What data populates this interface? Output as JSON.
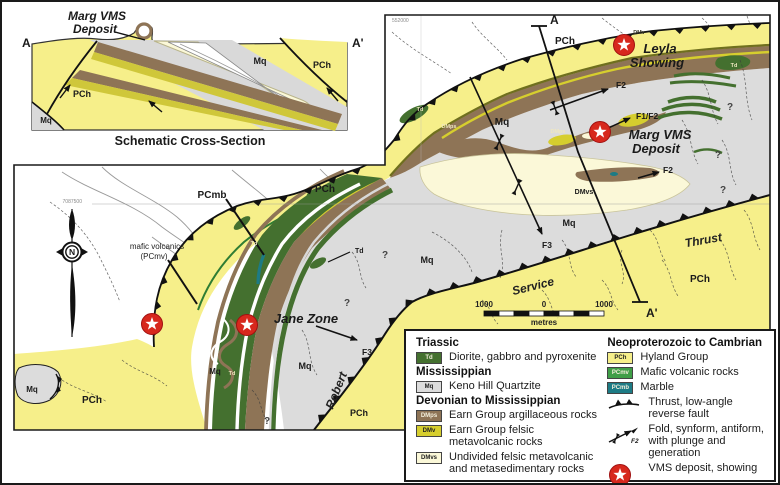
{
  "cross_section": {
    "marker_left": "A",
    "marker_right": "A'",
    "deposit_line1": "Marg VMS",
    "deposit_line2": "Deposit",
    "caption": "Schematic Cross-Section"
  },
  "map": {
    "marker_top": "A",
    "marker_bottom": "A'",
    "grid_easting": "552000",
    "grid_northing": "7087500",
    "north": "N",
    "locations": {
      "leyla_line1": "Leyla",
      "leyla_line2": "Showing",
      "marg_line1": "Marg VMS",
      "marg_line2": "Deposit",
      "jane": "Jane Zone"
    },
    "fault_name": {
      "robert": "Robert",
      "service": "Service",
      "thrust": "Thrust"
    },
    "folds": {
      "f2": "F2",
      "f1f2": "F1/F2",
      "f3": "F3"
    },
    "uncertain": "?",
    "codes": {
      "pch": "PCh",
      "mq": "Mq",
      "td": "Td",
      "dmps": "DMps",
      "dmv": "DMv",
      "dmvs": "DMvs",
      "pcmb": "PCmb"
    },
    "annotation": {
      "mafic_line1": "mafic volcanics",
      "mafic_line2": "(PCmv)"
    },
    "scale": {
      "left": "1000",
      "zero": "0",
      "right": "1000",
      "unit": "metres"
    }
  },
  "legend": {
    "groups": [
      {
        "heading": "Triassic",
        "items": [
          {
            "code": "Td",
            "label": "Diorite, gabbro and pyroxenite",
            "color": "#44702f"
          }
        ]
      },
      {
        "heading": "Mississippian",
        "items": [
          {
            "code": "Mq",
            "label": "Keno Hill Quartzite",
            "color": "#dcdcdc"
          }
        ]
      },
      {
        "heading": "Devonian to Mississippian",
        "items": [
          {
            "code": "DMps",
            "label": "Earn Group argillaceous rocks",
            "color": "#8e7456"
          },
          {
            "code": "DMv",
            "label": "Earn Group felsic metavolcanic rocks",
            "color": "#d6ce2e"
          },
          {
            "code": "DMvs",
            "label": "Undivided felsic metavolcanic and metasedimentary rocks",
            "color": "#fbf8d8"
          }
        ]
      },
      {
        "heading": "Neoproterozoic to Cambrian",
        "items": [
          {
            "code": "PCh",
            "label": "Hyland Group",
            "color": "#f6ef8a"
          },
          {
            "code": "PCmv",
            "label": "Mafic volcanic rocks",
            "color": "#3f9e47"
          },
          {
            "code": "PCmb",
            "label": "Marble",
            "color": "#1d7b85"
          }
        ]
      }
    ],
    "symbols": [
      {
        "label": "Thrust, low-angle reverse fault"
      },
      {
        "label": "Fold, synform, antiform, with plunge and generation",
        "tag": "F2"
      },
      {
        "label": "VMS deposit, showing"
      }
    ]
  },
  "colors": {
    "pch": "#f6ef8a",
    "mq": "#dcdcdc",
    "dmps": "#8e7456",
    "dmv": "#d6ce2e",
    "dmvs": "#fbf8d8",
    "td": "#44702f",
    "pcmv": "#3f9e47",
    "pcmb": "#1d7b85",
    "star": "#d7281d"
  }
}
